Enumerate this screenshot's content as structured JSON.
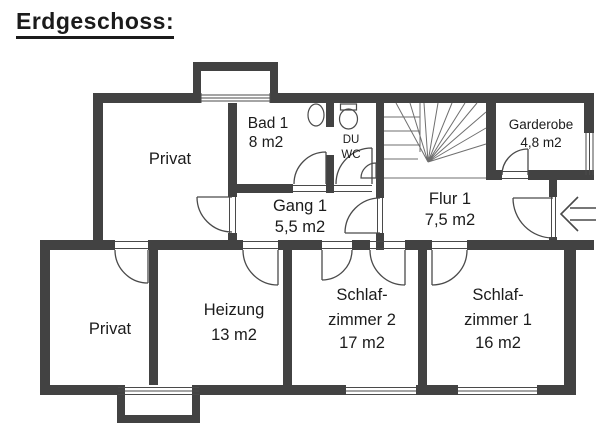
{
  "title": "Erdgeschoss:",
  "rooms": {
    "privat_upper": {
      "name": "Privat"
    },
    "bad1": {
      "name": "Bad 1",
      "area": "8 m2"
    },
    "duwc": {
      "line1": "DU",
      "line2": "WC"
    },
    "garderobe": {
      "name": "Garderobe",
      "area": "4,8 m2"
    },
    "flur1": {
      "name": "Flur 1",
      "area": "7,5 m2"
    },
    "gang1": {
      "name": "Gang 1",
      "area": "5,5 m2"
    },
    "privat_lower": {
      "name": "Privat"
    },
    "heizung": {
      "name": "Heizung",
      "area": "13 m2"
    },
    "schlafzimmer2": {
      "line1": "Schlaf-",
      "line2": "zimmer 2",
      "area": "17 m2"
    },
    "schlafzimmer1": {
      "line1": "Schlaf-",
      "line2": "zimmer 1",
      "area": "16 m2"
    }
  },
  "colors": {
    "background": "#ffffff",
    "wall": "#424242",
    "line": "#4a4a4a",
    "stair": "#6f6f6f",
    "text": "#1b1b1b"
  }
}
